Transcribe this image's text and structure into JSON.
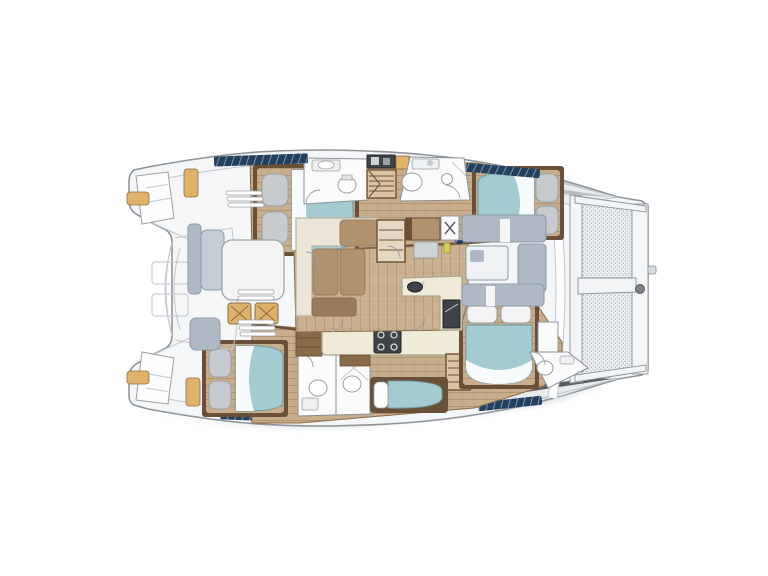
{
  "meta": {
    "description": "Top-down interior layout plan of a sailing catamaran with four double cabins, heads, saloon, galley, forward cockpit, aft cockpit and bow trampoline",
    "diagram_type": "yacht-floor-plan",
    "orientation": "bow-right-stern-left"
  },
  "palette": {
    "page_bg": "#ffffff",
    "hull_fill": "#f5f6f7",
    "hull_stroke": "#8d949b",
    "line_light": "#c3c8cd",
    "deck_gray": "#e9ebed",
    "deck_shadow": "#aab1b8",
    "dark_wedge": "#565c62",
    "wood": "#c8ae8d",
    "wood_dark": "#a98d6a",
    "trim": "#6a5038",
    "trim2": "#8a6b49",
    "cream": "#ece6d9",
    "counter": "#f0ead9",
    "cushion": "#b0926f",
    "cushion_dark": "#9a7c5c",
    "teal": "#a3cbd1",
    "teal_dark": "#7fb3bc",
    "white_room": "#fbfbfb",
    "pillow_gray": "#c7cbd0",
    "gray_seat": "#aeb9c4",
    "gray_seat_dark": "#8d9aa8",
    "navy": "#23415f",
    "tan_pad": "#e0b269",
    "dark_appliance": "#3e4347",
    "mesh_bg": "#eceef0",
    "mesh_dot": "#b6bbc1",
    "shadow": "#cfd3d6",
    "accent_yellow": "#cdd24e"
  },
  "regions": {
    "hull": "Catamaran hull and deck outline",
    "trampoline": "Bow trampoline net",
    "aft_cockpit": "Aft cockpit with lounge, table and chairs",
    "forward_cockpit": "Forward cockpit seating",
    "saloon": "Saloon with L-shaped sofa",
    "galley": "Galley island with stove and sink",
    "nav_station": "Navigation station",
    "port_aft_cabin": "Port aft double cabin",
    "port_aft_head": "Port aft head",
    "port_fwd_head": "Port forward head",
    "port_fwd_cabin": "Port forward double cabin",
    "stbd_aft_cabin": "Starboard aft double cabin",
    "stbd_head": "Starboard head and shower",
    "single_berth": "Starboard single berth",
    "stbd_fwd_cabin": "Starboard forward double cabin",
    "bow_head": "Starboard bow head",
    "stairs": "Companionway steps"
  }
}
